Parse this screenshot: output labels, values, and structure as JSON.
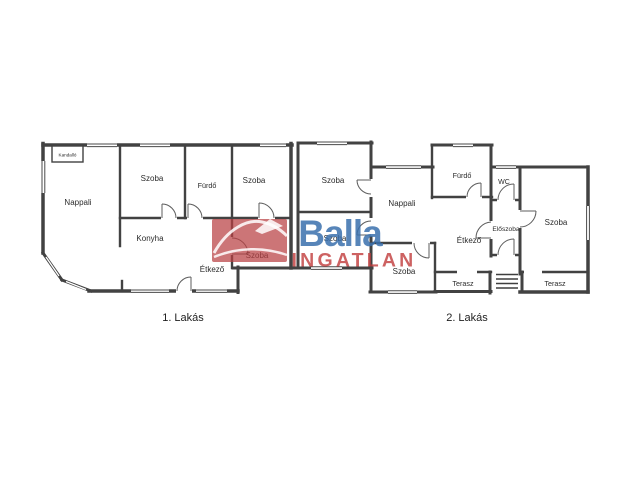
{
  "floorplan": {
    "captions": {
      "apartment_1": "1. Lakás",
      "apartment_2": "2. Lakás"
    },
    "rooms": {
      "kandallo": "Kandalló",
      "nappali_1": "Nappali",
      "szoba_1": "Szoba",
      "furdo_1": "Fürdő",
      "szoba_2": "Szoba",
      "konyha": "Konyha",
      "etkezo_1": "Étkező",
      "szoba_3": "Szoba",
      "szoba_4": "Szoba",
      "szoba_5": "Szoba",
      "nappali_2": "Nappali",
      "furdo_2": "Fürdő",
      "wc": "WC",
      "etkezo_2": "Étkező",
      "eloszoba": "Előszoba",
      "szoba_6": "Szoba",
      "terasz_1": "Terasz",
      "szoba_7": "Szoba",
      "terasz_2": "Terasz"
    }
  },
  "watermark": {
    "brand": "Balla",
    "brand_sub": "INGATLAN",
    "blue": "#3a70ad",
    "red": "#c13c3c",
    "box_red": "#b84043"
  },
  "colors": {
    "wall": "#424242",
    "label": "#2b2b2b",
    "background": "#ffffff"
  }
}
